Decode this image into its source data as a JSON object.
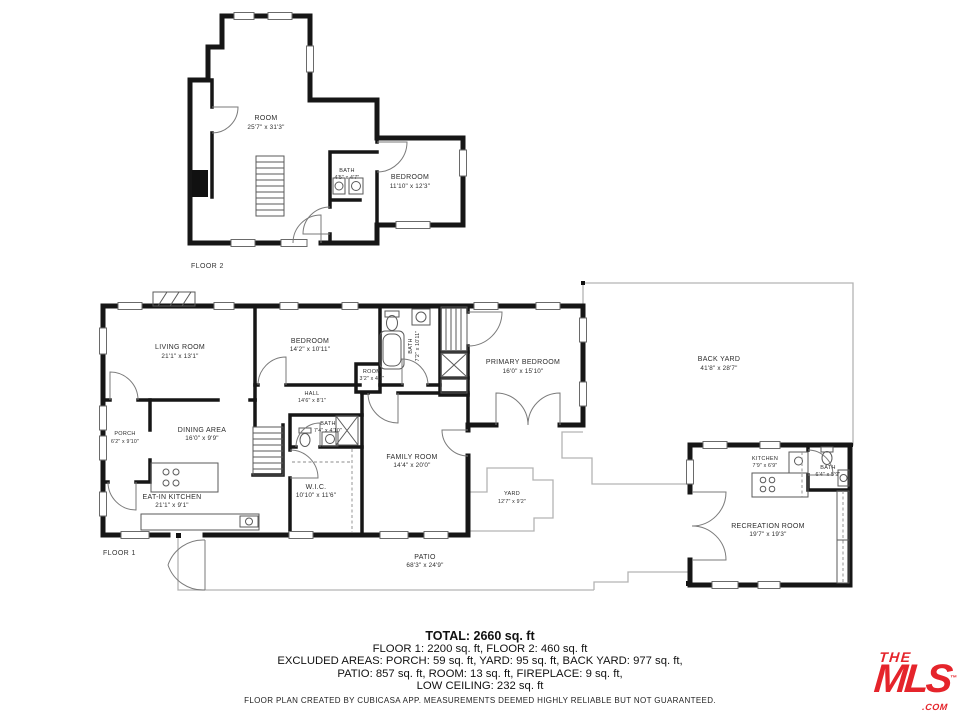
{
  "floor2": {
    "label": "FLOOR 2",
    "rooms": {
      "room": {
        "name": "ROOM",
        "dims": "25'7\" x 31'3\""
      },
      "bath": {
        "name": "BATH",
        "dims": "4'5\" x 4'7\""
      },
      "bedroom": {
        "name": "BEDROOM",
        "dims": "11'10\" x 12'3\""
      }
    }
  },
  "floor1": {
    "label": "FLOOR 1",
    "rooms": {
      "living_room": {
        "name": "LIVING ROOM",
        "dims": "21'1\" x 13'1\""
      },
      "bedroom": {
        "name": "BEDROOM",
        "dims": "14'2\" x 10'11\""
      },
      "hall": {
        "name": "HALL",
        "dims": "14'6\" x 8'1\""
      },
      "room_small": {
        "name": "ROOM",
        "dims": "3'2\" x 4'1\""
      },
      "bath_main": {
        "name": "BATH",
        "dims": "7'2\" x 10'11\""
      },
      "primary_bedroom": {
        "name": "PRIMARY BEDROOM",
        "dims": "16'0\" x 15'10\""
      },
      "back_yard": {
        "name": "BACK YARD",
        "dims": "41'8\" x 28'7\""
      },
      "porch": {
        "name": "PORCH",
        "dims": "6'2\" x 9'10\""
      },
      "dining_area": {
        "name": "DINING AREA",
        "dims": "16'0\" x 9'9\""
      },
      "eat_in_kitchen": {
        "name": "EAT-IN KITCHEN",
        "dims": "21'1\" x 9'1\""
      },
      "bath_small": {
        "name": "BATH",
        "dims": "7'4\" x 4'10\""
      },
      "wic": {
        "name": "W.I.C.",
        "dims": "10'10\" x 11'6\""
      },
      "family_room": {
        "name": "FAMILY ROOM",
        "dims": "14'4\" x 20'0\""
      },
      "yard": {
        "name": "YARD",
        "dims": "12'7\" x 9'2\""
      },
      "kitchen": {
        "name": "KITCHEN",
        "dims": "7'9\" x 6'9\""
      },
      "bath_rec": {
        "name": "BATH",
        "dims": "6'4\" x 5'9\""
      },
      "recreation_room": {
        "name": "RECREATION ROOM",
        "dims": "19'7\" x 19'3\""
      },
      "patio": {
        "name": "PATIO",
        "dims": "68'3\" x 24'9\""
      }
    }
  },
  "summary": {
    "total": "TOTAL: 2660 sq. ft",
    "line2": "FLOOR 1: 2200 sq. ft, FLOOR 2: 460 sq. ft",
    "line3": "EXCLUDED AREAS: PORCH: 59 sq. ft, YARD: 95 sq. ft, BACK YARD: 977 sq. ft,",
    "line4": "PATIO: 857 sq. ft, ROOM: 13 sq. ft, FIREPLACE: 9 sq. ft,",
    "line5": "LOW CEILING: 232 sq. ft"
  },
  "footer": {
    "disclaimer": "FLOOR PLAN CREATED BY CUBICASA APP. MEASUREMENTS DEEMED HIGHLY RELIABLE BUT NOT GUARANTEED."
  },
  "logo": {
    "the": "THE",
    "mls": "MLS",
    "com": ".COM",
    "tm": "™",
    "color": "#e5242b"
  }
}
